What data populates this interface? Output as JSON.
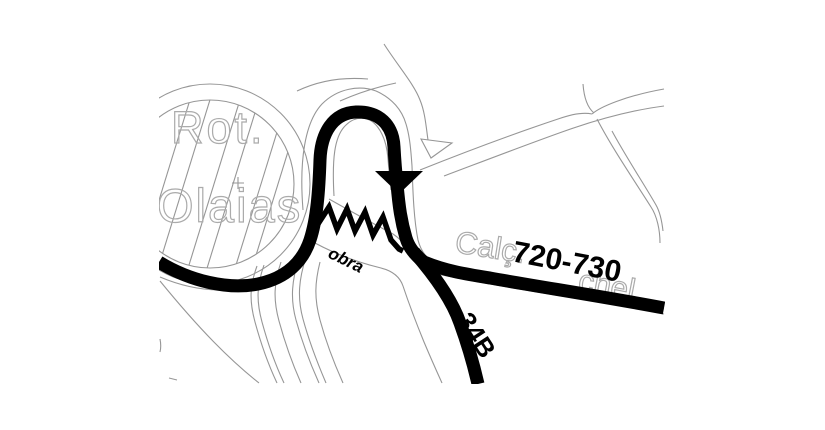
{
  "map": {
    "type": "street-map-detail",
    "background_color": "#ffffff",
    "route_color": "#000000",
    "street_line_color": "#969696",
    "ghost_label_color": "#ababab",
    "labels": {
      "roundabout_line1": "Rot.",
      "roundabout_line2": "Olaias",
      "street_name_prefix": "Calç.",
      "street_name_fragment": "chel",
      "stop_range": "720-730",
      "route_number": "34B",
      "construction": "obra"
    },
    "symbols": [
      {
        "name": "direction-arrow",
        "meaning": "route direction (downward)"
      },
      {
        "name": "construction-zigzag",
        "meaning": "roadworks (obra)"
      }
    ]
  }
}
